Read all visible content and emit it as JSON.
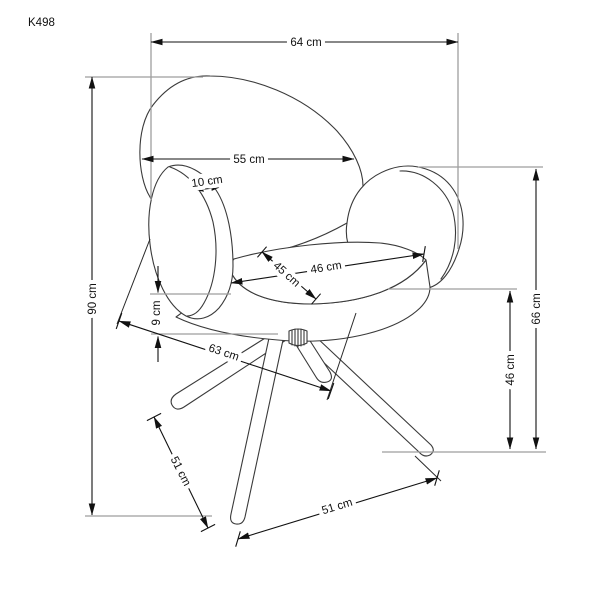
{
  "drawing": {
    "product_code": "K498",
    "object": "swivel-armchair-dimension-diagram",
    "units": "cm",
    "colors": {
      "background": "#ffffff",
      "chair_outline": "#3a3a3a",
      "dimension_lines": "#111111",
      "extension_lines": "#9e9e9e",
      "text": "#111111"
    },
    "dimensions": [
      {
        "id": "overall-width",
        "label": "64 cm",
        "value": 64
      },
      {
        "id": "backrest-width",
        "label": "55 cm",
        "value": 55
      },
      {
        "id": "armrest-thickness",
        "label": "10 cm",
        "value": 10
      },
      {
        "id": "overall-height",
        "label": "90 cm",
        "value": 90
      },
      {
        "id": "seat-edge-thickness",
        "label": "9 cm",
        "value": 9
      },
      {
        "id": "seat-depth",
        "label": "45 cm",
        "value": 45
      },
      {
        "id": "seat-width",
        "label": "46 cm",
        "value": 46
      },
      {
        "id": "base-depth",
        "label": "63 cm",
        "value": 63
      },
      {
        "id": "armrest-height",
        "label": "66 cm",
        "value": 66
      },
      {
        "id": "seat-height",
        "label": "46 cm",
        "value": 46
      },
      {
        "id": "base-diagonal-side",
        "label": "51 cm",
        "value": 51
      },
      {
        "id": "base-diagonal-front",
        "label": "51 cm",
        "value": 51
      }
    ]
  }
}
